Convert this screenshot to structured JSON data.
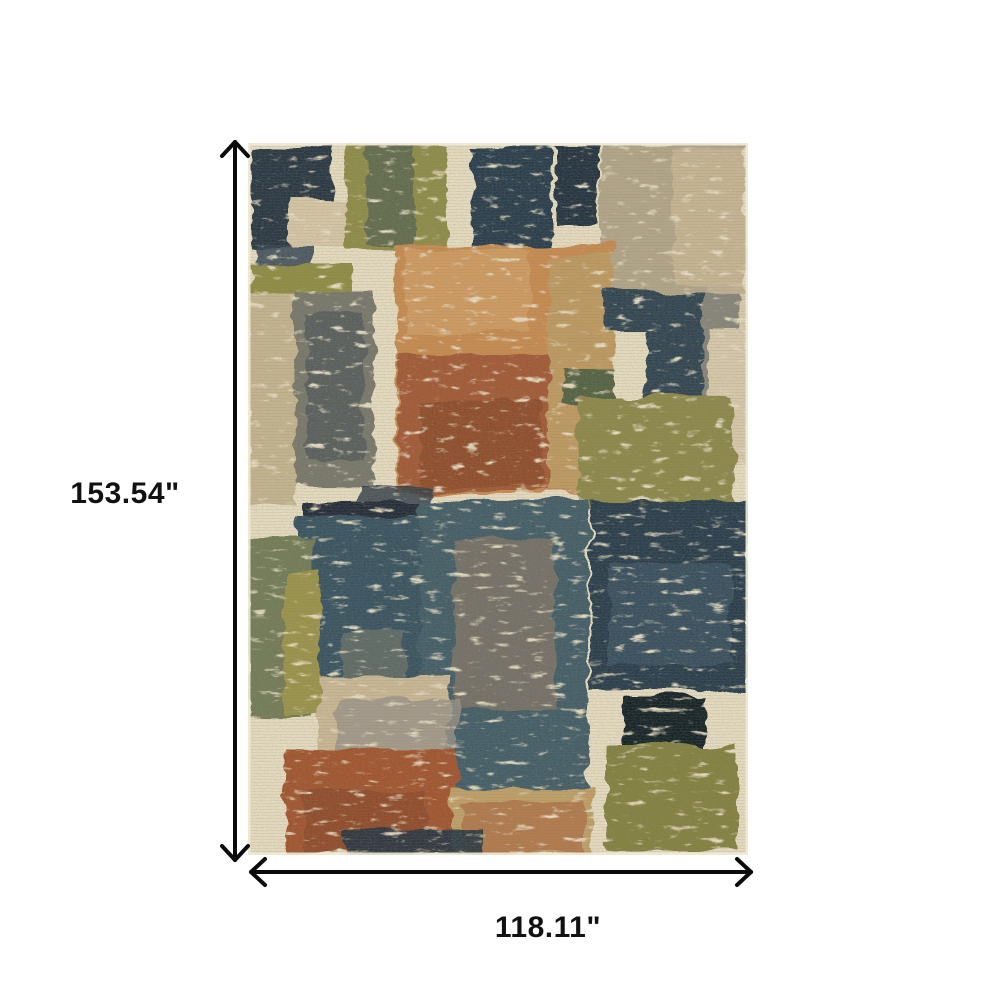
{
  "figure": {
    "type": "product-dimension-diagram",
    "subject": "abstract patchwork area rug",
    "height_label": "153.54\"",
    "width_label": "118.11\"",
    "arrow_color": "#0a0a0a",
    "label_color": "#111111"
  },
  "rug": {
    "base_color": "#eae0c4",
    "palette": {
      "navy": "#22313f",
      "ink": "#0e1a24",
      "teal": "#3e5a66",
      "slate": "#75766a",
      "olive": "#8d8c44",
      "sage": "#6f7a55",
      "dark_green": "#50613f",
      "taupe": "#b3a689",
      "tan": "#c6b690",
      "beige": "#d9c9a8",
      "grey": "#9a9288",
      "orange": "#c98a4e",
      "rust": "#a35730",
      "deep_rust": "#8a4527",
      "gold": "#c09a5e"
    },
    "blocks": [
      {
        "x": 4,
        "y": 4,
        "w": 80,
        "h": 100,
        "c": "#22313f"
      },
      {
        "x": 8,
        "y": 100,
        "w": 54,
        "h": 64,
        "c": "#2b3c50",
        "o": 0.85
      },
      {
        "x": 42,
        "y": 56,
        "w": 70,
        "h": 50,
        "c": "#d9c9a8"
      },
      {
        "x": 97,
        "y": 3,
        "w": 102,
        "h": 106,
        "c": "#8d8c44"
      },
      {
        "x": 118,
        "y": 3,
        "w": 48,
        "h": 102,
        "c": "#54624d",
        "o": 0.8
      },
      {
        "x": 224,
        "y": 4,
        "w": 80,
        "h": 102,
        "c": "#233748"
      },
      {
        "x": 308,
        "y": 5,
        "w": 42,
        "h": 76,
        "c": "#1e2e3c"
      },
      {
        "x": 352,
        "y": 3,
        "w": 146,
        "h": 146,
        "c": "#b3a689"
      },
      {
        "x": 424,
        "y": 8,
        "w": 74,
        "h": 134,
        "c": "#c9b795",
        "o": 0.95
      },
      {
        "x": 148,
        "y": 102,
        "w": 218,
        "h": 250,
        "c": "#c98a4e"
      },
      {
        "x": 158,
        "y": 106,
        "w": 124,
        "h": 84,
        "c": "#d39c61",
        "o": 0.9
      },
      {
        "x": 150,
        "y": 212,
        "w": 162,
        "h": 138,
        "c": "#a35730"
      },
      {
        "x": 172,
        "y": 258,
        "w": 122,
        "h": 88,
        "c": "#8a4527",
        "o": 0.8
      },
      {
        "x": 300,
        "y": 114,
        "w": 66,
        "h": 236,
        "c": "#c09a5e"
      },
      {
        "x": 4,
        "y": 120,
        "w": 98,
        "h": 30,
        "c": "#8d8c40"
      },
      {
        "x": 0,
        "y": 150,
        "w": 48,
        "h": 214,
        "c": "#c6b690"
      },
      {
        "x": 46,
        "y": 148,
        "w": 80,
        "h": 194,
        "c": "#75766a"
      },
      {
        "x": 58,
        "y": 168,
        "w": 58,
        "h": 150,
        "c": "#3d4a52",
        "o": 0.6
      },
      {
        "x": 358,
        "y": 148,
        "w": 132,
        "h": 40,
        "c": "#2b4050"
      },
      {
        "x": 398,
        "y": 152,
        "w": 62,
        "h": 130,
        "c": "#2b4050"
      },
      {
        "x": 455,
        "y": 140,
        "w": 45,
        "h": 180,
        "c": "#cdbc9c",
        "o": 0.55
      },
      {
        "x": 315,
        "y": 224,
        "w": 52,
        "h": 38,
        "c": "#50613f"
      },
      {
        "x": 330,
        "y": 254,
        "w": 156,
        "h": 110,
        "c": "#8b8846"
      },
      {
        "x": 110,
        "y": 346,
        "w": 72,
        "h": 30,
        "c": "#2a3a46",
        "o": 0.85,
        "g": "b"
      },
      {
        "x": 55,
        "y": 358,
        "w": 116,
        "h": 44,
        "c": "#1a2836",
        "g": "b"
      },
      {
        "x": 48,
        "y": 372,
        "w": 128,
        "h": 172,
        "c": "#32505e",
        "g": "b"
      },
      {
        "x": 0,
        "y": 396,
        "w": 66,
        "h": 176,
        "c": "#6f7a55",
        "g": "b"
      },
      {
        "x": 36,
        "y": 428,
        "w": 36,
        "h": 142,
        "c": "#9a9347",
        "g": "b"
      },
      {
        "x": 172,
        "y": 357,
        "w": 168,
        "h": 300,
        "c": "#3e5a66",
        "g": "b"
      },
      {
        "x": 205,
        "y": 396,
        "w": 102,
        "h": 172,
        "c": "#7b7266",
        "o": 0.85,
        "g": "b"
      },
      {
        "x": 95,
        "y": 488,
        "w": 62,
        "h": 70,
        "c": "#5e6a66",
        "o": 0.9,
        "g": "b"
      },
      {
        "x": 342,
        "y": 357,
        "w": 158,
        "h": 192,
        "c": "#233749",
        "g": "b"
      },
      {
        "x": 360,
        "y": 420,
        "w": 122,
        "h": 102,
        "c": "#3a5666",
        "o": 0.7,
        "g": "b"
      },
      {
        "x": 375,
        "y": 554,
        "w": 82,
        "h": 54,
        "c": "#0e1a24",
        "g": "b"
      },
      {
        "x": 70,
        "y": 534,
        "w": 130,
        "h": 106,
        "c": "#ccb996",
        "g": "b"
      },
      {
        "x": 88,
        "y": 556,
        "w": 122,
        "h": 64,
        "c": "#9a9288",
        "o": 0.8,
        "g": "b"
      },
      {
        "x": 38,
        "y": 608,
        "w": 172,
        "h": 104,
        "c": "#a2512c",
        "g": "b"
      },
      {
        "x": 56,
        "y": 648,
        "w": 122,
        "h": 64,
        "c": "#8c4426",
        "o": 0.8,
        "g": "b"
      },
      {
        "x": 205,
        "y": 646,
        "w": 140,
        "h": 66,
        "c": "#c1a066",
        "g": "b"
      },
      {
        "x": 215,
        "y": 658,
        "w": 122,
        "h": 52,
        "c": "#a8582f",
        "o": 0.55,
        "g": "b"
      },
      {
        "x": 358,
        "y": 602,
        "w": 132,
        "h": 106,
        "c": "#82803d",
        "g": "b"
      },
      {
        "x": 95,
        "y": 686,
        "w": 138,
        "h": 26,
        "c": "#1f3040",
        "o": 0.9,
        "g": "b"
      }
    ]
  }
}
